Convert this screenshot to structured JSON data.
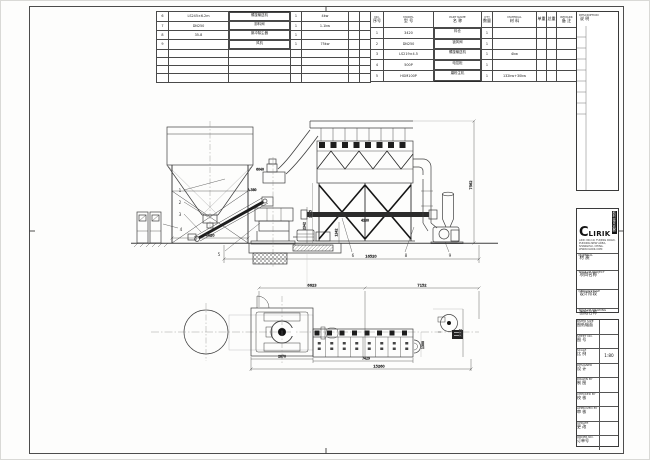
{
  "meta": {
    "drawing_type": "equipment layout drawing",
    "company": "CLIRIK",
    "paper_color": "#ffffff",
    "line_color": "#3f3f3f",
    "dark_color": "#1a1a1a"
  },
  "parts_table_right": {
    "headers": {
      "no_en": "NO.",
      "no_cn": "序号",
      "model_en": "MODEL",
      "model_cn": "型 号",
      "name_en": "PART NAME",
      "name_cn": "名 称",
      "qty_en": "QTY",
      "qty_cn": "数量",
      "material_en": "MATERIAL",
      "material_cn": "材 料",
      "wt_unit": "单重",
      "wt_total": "总重",
      "remark_en": "REMARK",
      "remark_cn": "备 注"
    },
    "rows": [
      {
        "no": "1",
        "model": "3420",
        "name": "料仓",
        "qty": "1",
        "material": "",
        "remark": ""
      },
      {
        "no": "2",
        "model": "DN250",
        "name": "锁风阀",
        "qty": "1",
        "material": "",
        "remark": ""
      },
      {
        "no": "3",
        "model": "LS219×4.5",
        "name": "螺旋输送机",
        "qty": "1",
        "material": "4kw",
        "remark": ""
      },
      {
        "no": "4",
        "model": "500P",
        "name": "电控柜",
        "qty": "1",
        "material": "",
        "remark": ""
      },
      {
        "no": "5",
        "model": "HGM100P",
        "name": "磨粉主机",
        "qty": "1",
        "material": "132kw+30kw",
        "remark": ""
      }
    ]
  },
  "parts_table_left": {
    "rows": [
      {
        "no": "6",
        "model": "LS245×6.2m",
        "name": "螺旋输送机",
        "qty": "1",
        "material": "4kw"
      },
      {
        "no": "7",
        "model": "DN250",
        "name": "卸料阀",
        "qty": "1",
        "material": "1.1kw"
      },
      {
        "no": "8",
        "model": "35-8",
        "name": "脉冲除尘器",
        "qty": "1",
        "material": ""
      },
      {
        "no": "9",
        "model": "",
        "name": "风机",
        "qty": "1",
        "material": "75kw"
      }
    ]
  },
  "title_block": {
    "description_en": "DESCRIPTION",
    "description_cn": "说 明",
    "logo_text": "CLIRIK",
    "logo_c": "C",
    "logo_rest": "LIRIK",
    "logo_cn": "科利瑞克机器",
    "address_line1": "ADD: NO.19, FUQING ROAD, PUDONG NEW AREA,",
    "address_line2": "SHANGHAI, CHINA.  WWW.CLIRIK.COM",
    "fields": [
      {
        "en": "MATERIAL",
        "cn": "材 质",
        "value": ""
      },
      {
        "en": "TITLE OF PROJECT",
        "cn": "项目名称",
        "value": ""
      },
      {
        "en": "DESIGN STAGE",
        "cn": "设计阶段",
        "value": ""
      },
      {
        "en": "TITLE OF DRAWING",
        "cn": "图纸名称",
        "value": ""
      }
    ],
    "rows": [
      {
        "en": "PAPER SIZE",
        "cn": "图纸幅面",
        "value": ""
      },
      {
        "en": "SHEET NO.",
        "cn": "图 号",
        "value": ""
      },
      {
        "en": "SCALE",
        "cn": "比 例",
        "value": "1:80"
      },
      {
        "en": "DESIGNER",
        "cn": "设 计",
        "value": ""
      },
      {
        "en": "DRAWN BY",
        "cn": "制 图",
        "value": ""
      },
      {
        "en": "CHECKED BY",
        "cn": "校 核",
        "value": ""
      },
      {
        "en": "APPROVED BY",
        "cn": "审 核",
        "value": ""
      },
      {
        "en": "UPDATE",
        "cn": "更 改",
        "value": ""
      },
      {
        "en": "ORDER NO.",
        "cn": "订单号",
        "value": ""
      }
    ]
  },
  "dims": {
    "elev_total": "16520",
    "elev_height": "7562",
    "hopper_span": "4420",
    "mill_h1": "2342",
    "mill_h2": "3735",
    "bag_leg": "1342",
    "screw_len": "4130",
    "plan_left": "6623",
    "plan_right": "7152",
    "plan_mill": "2870",
    "plan_bag": "7429",
    "plan_total": "15260",
    "plan_depth": "2022",
    "plan_small": "1300",
    "ref_a": "A-380",
    "ref_b": "6040"
  },
  "balloons": {
    "b1": "1",
    "b2": "2",
    "b3": "3",
    "b4": "4",
    "b5": "5",
    "b6": "6",
    "b8": "8",
    "b9": "9"
  }
}
